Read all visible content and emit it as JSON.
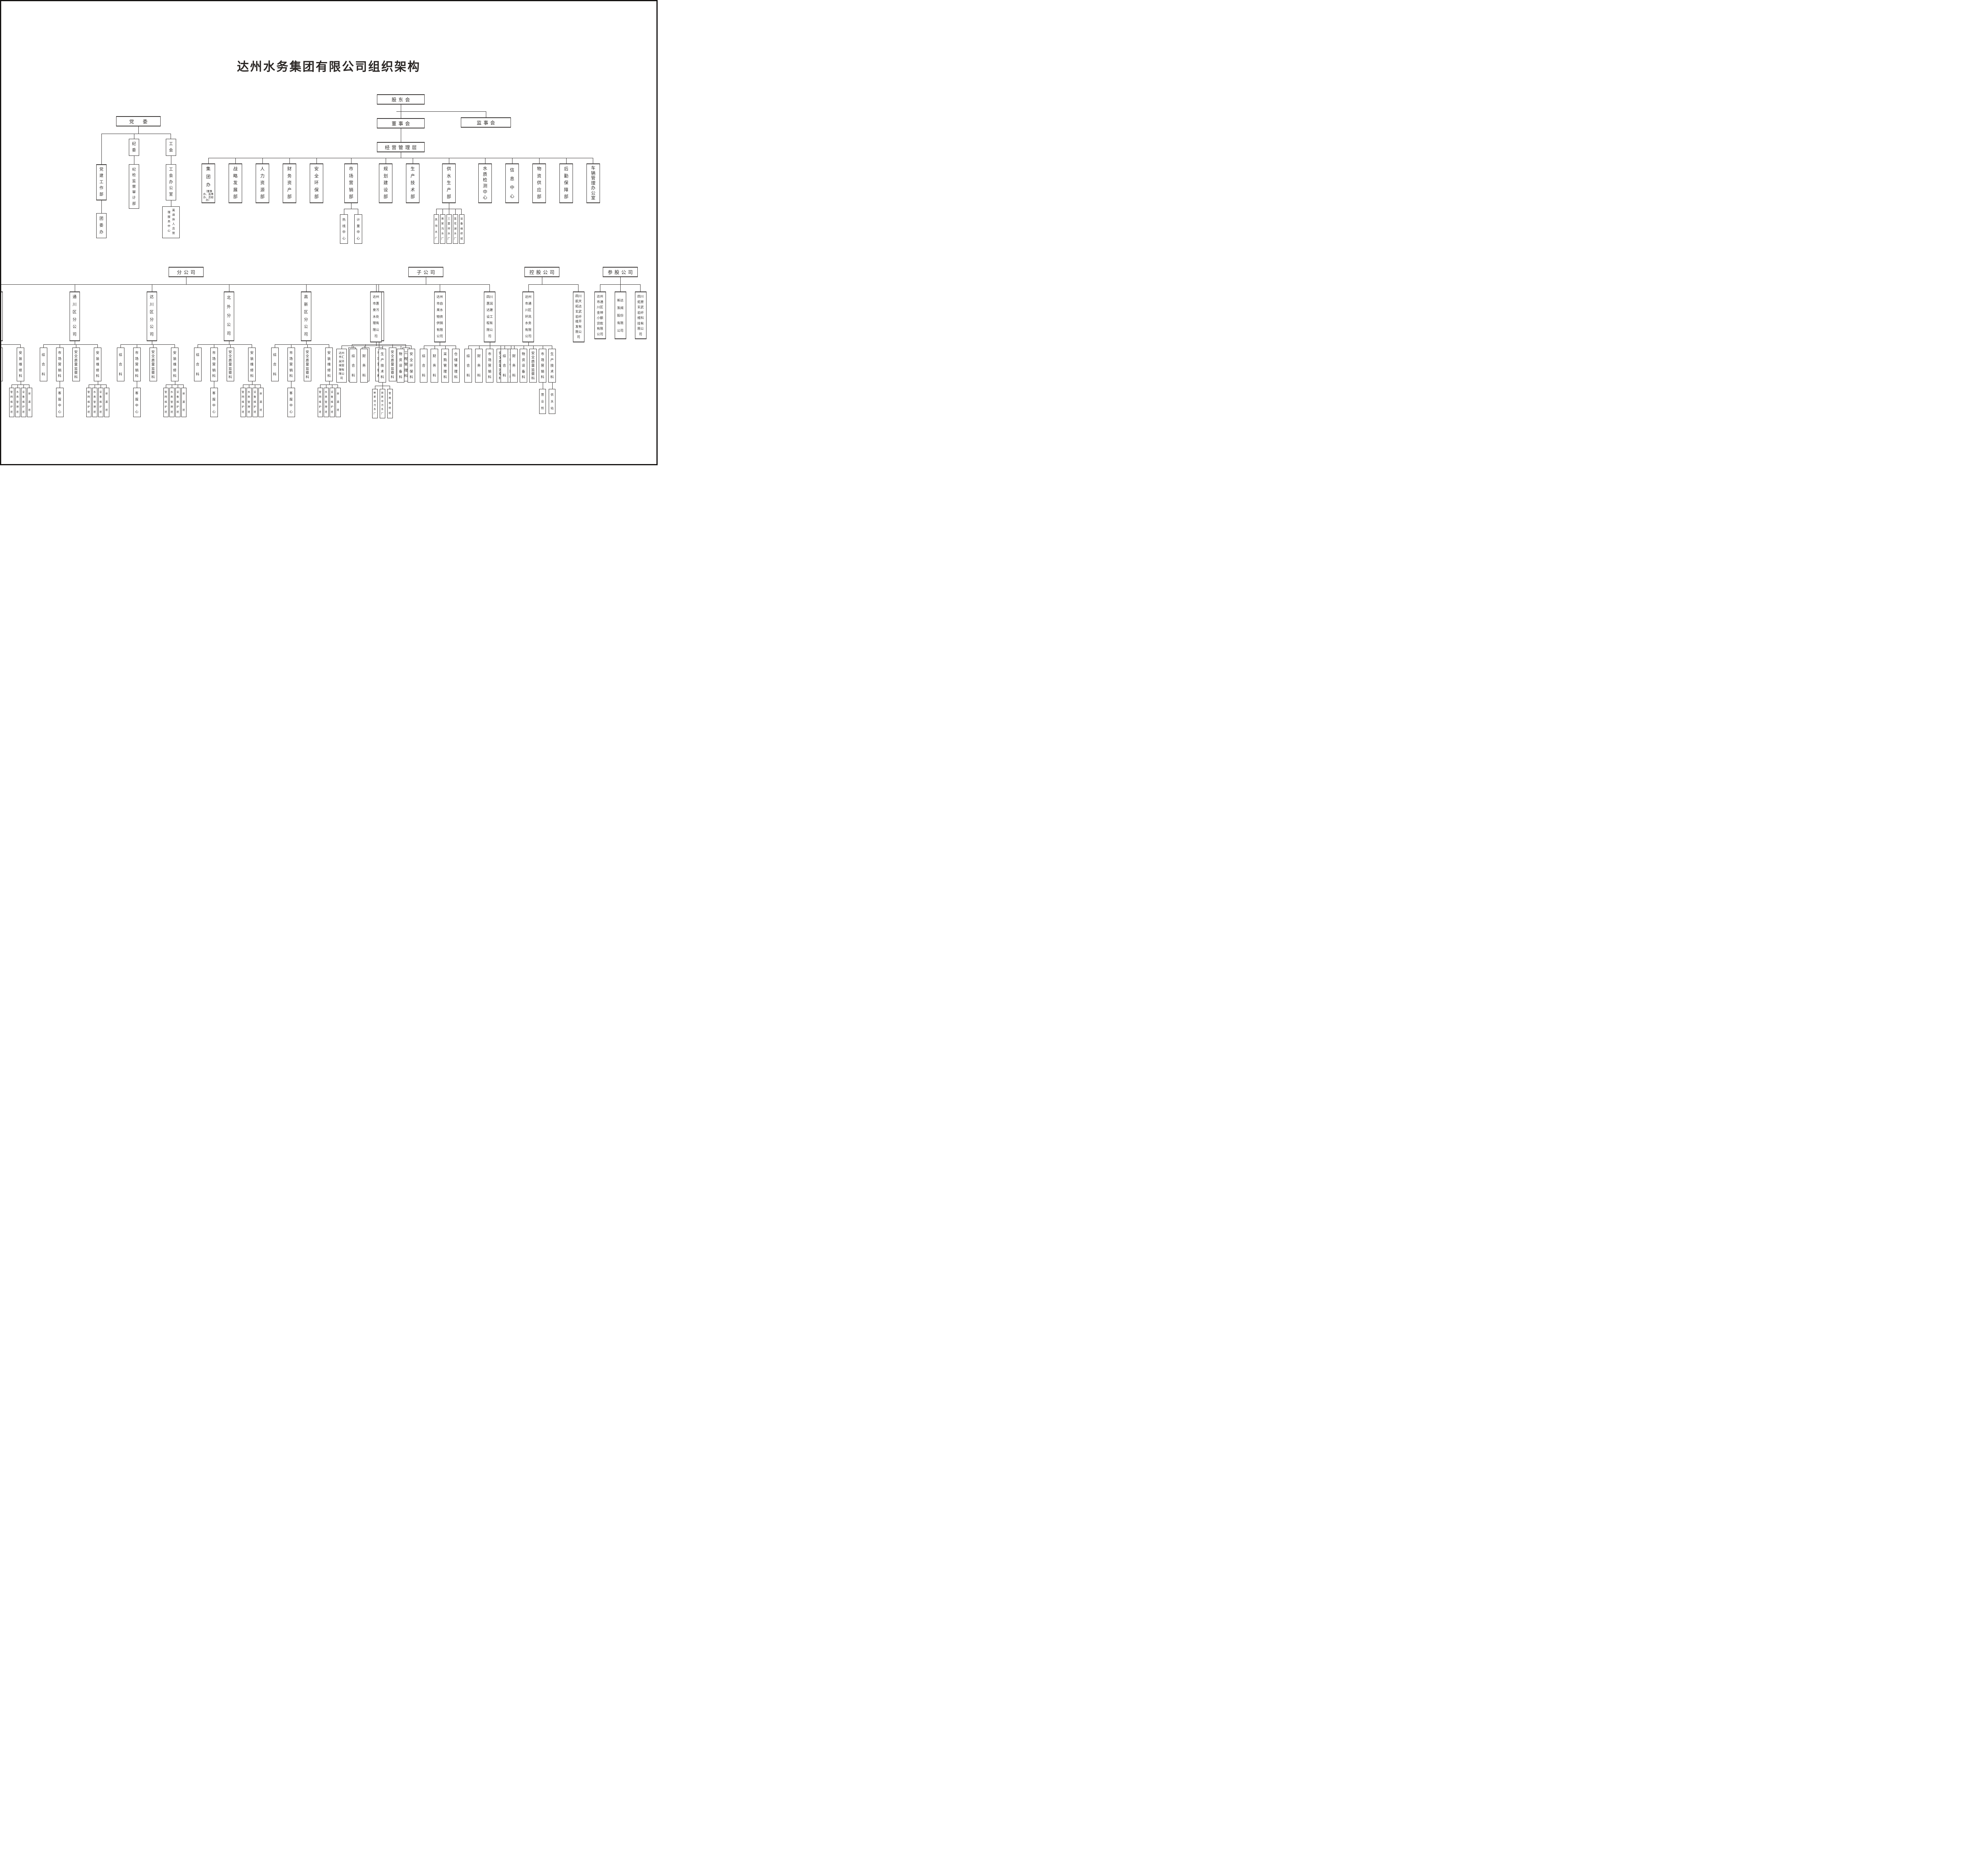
{
  "title": "达州水务集团有限公司组织架构",
  "trees": {
    "supervisory": {
      "label": "监事会"
    },
    "governance": {
      "label": "股东会",
      "children": [
        {
          "label": "董事会",
          "children": [
            {
              "label": "经营管理层",
              "children": [
                {
                  "label": "集团办",
                  "sub": "（董事办、监事办、总经办）"
                },
                {
                  "label": "战略发展部"
                },
                {
                  "label": "人力资源部"
                },
                {
                  "label": "财务资产部"
                },
                {
                  "label": "安全环保部"
                },
                {
                  "label": "市场营销部",
                  "children": [
                    {
                      "label": "热线中心"
                    },
                    {
                      "label": "计量中心"
                    }
                  ]
                },
                {
                  "label": "规划建设部"
                },
                {
                  "label": "生产技术部"
                },
                {
                  "label": "供水生产部",
                  "children": [
                    {
                      "label": "凤翎水厂"
                    },
                    {
                      "label": "吴家沟水厂"
                    },
                    {
                      "label": "三里坪水厂"
                    },
                    {
                      "label": "莲花湖水厂"
                    },
                    {
                      "label": "设备维修班"
                    }
                  ]
                },
                {
                  "label": "水质检测中心"
                },
                {
                  "label": "信息中心"
                },
                {
                  "label": "物资供应部"
                },
                {
                  "label": "后勤保障部"
                },
                {
                  "label": "车辆管理办公室"
                }
              ]
            }
          ]
        }
      ]
    },
    "party": {
      "label": "党　委",
      "children": [
        {
          "label": "党建工作部",
          "children": [
            {
              "label": "团委办"
            }
          ]
        },
        {
          "label": "纪委",
          "children": [
            {
              "label": "纪检监察审计部"
            }
          ]
        },
        {
          "label": "工会",
          "children": [
            {
              "label": "工会办公室",
              "children": [
                {
                  "label": "离退休人员管理服务中心"
                }
              ]
            }
          ]
        }
      ]
    },
    "branches": {
      "label": "分公司",
      "children": [
        {
          "label": "市中区分公司",
          "children": [
            {
              "label": "综合科"
            },
            {
              "label": "市场营销科",
              "children": [
                {
                  "label": "客服中心"
                }
              ]
            },
            {
              "label": "安全质量监察科"
            },
            {
              "label": "安装维修科",
              "children": [
                {
                  "label": "管网维护班"
                },
                {
                  "label": "水表管理班"
                },
                {
                  "label": "设备维护班"
                },
                {
                  "label": "探漏班"
                }
              ]
            }
          ]
        },
        {
          "label": "通川区分公司",
          "children": [
            {
              "label": "综合科"
            },
            {
              "label": "市场营销科",
              "children": [
                {
                  "label": "客服中心"
                }
              ]
            },
            {
              "label": "安全质量监察科"
            },
            {
              "label": "安装维修科",
              "children": [
                {
                  "label": "管网维护班"
                },
                {
                  "label": "水表管理班"
                },
                {
                  "label": "设备维护班"
                },
                {
                  "label": "探漏班"
                }
              ]
            }
          ]
        },
        {
          "label": "达川区分公司",
          "children": [
            {
              "label": "综合科"
            },
            {
              "label": "市场营销科",
              "children": [
                {
                  "label": "客服中心"
                }
              ]
            },
            {
              "label": "安全质量监察科"
            },
            {
              "label": "安装维修科",
              "children": [
                {
                  "label": "管网维护班"
                },
                {
                  "label": "水表管理班"
                },
                {
                  "label": "设备维护班"
                },
                {
                  "label": "探漏班"
                }
              ]
            }
          ]
        },
        {
          "label": "北外分公司",
          "children": [
            {
              "label": "综合科"
            },
            {
              "label": "市场营销科",
              "children": [
                {
                  "label": "客服中心"
                }
              ]
            },
            {
              "label": "安全质量监察科"
            },
            {
              "label": "安装维修科",
              "children": [
                {
                  "label": "管网维护班"
                },
                {
                  "label": "水表管理班"
                },
                {
                  "label": "设备维护班"
                },
                {
                  "label": "探漏班"
                }
              ]
            }
          ]
        },
        {
          "label": "高新区分公司",
          "children": [
            {
              "label": "综合科"
            },
            {
              "label": "市场营销科",
              "children": [
                {
                  "label": "客服中心"
                }
              ]
            },
            {
              "label": "安全质量监察科"
            },
            {
              "label": "安装维修科",
              "children": [
                {
                  "label": "管网维护班"
                },
                {
                  "label": "水表管理班"
                },
                {
                  "label": "设备维护班"
                },
                {
                  "label": "探漏班"
                }
              ]
            }
          ]
        },
        {
          "label": "安装工程分公司",
          "children": [
            {
              "label": "综合科"
            },
            {
              "label": "财务科"
            },
            {
              "label": "市场营销科"
            },
            {
              "label": "安全质量监察科"
            },
            {
              "label": "工程管理科"
            }
          ]
        }
      ]
    },
    "subsidiaries": {
      "label": "子公司",
      "children": [
        {
          "label": "达州市惠泉污水处理有限公司",
          "children": [
            {
              "label": "达州市汇泉环境管理有限公司"
            },
            {
              "label": "综合科"
            },
            {
              "label": "财务科"
            },
            {
              "label": "生产技术科",
              "children": [
                {
                  "label": "鲜家坝污水厂"
                },
                {
                  "label": "周家坝污水厂"
                },
                {
                  "label": "管网维修班"
                }
              ]
            },
            {
              "label": "物资设备科"
            },
            {
              "label": "安全环保科"
            }
          ]
        },
        {
          "label": "达州市自来水物资供销有限公司",
          "children": [
            {
              "label": "综合科"
            },
            {
              "label": "财务科"
            },
            {
              "label": "采购管理科"
            },
            {
              "label": "仓储管理科"
            }
          ]
        },
        {
          "label": "四川惠润达建设工程有限公司",
          "children": [
            {
              "label": "综合科"
            },
            {
              "label": "财务科"
            },
            {
              "label": "市场营销科"
            },
            {
              "label": "安全质量监察科"
            },
            {
              "label": "工程管理科"
            }
          ]
        }
      ]
    },
    "holding": {
      "label": "控股公司",
      "children": [
        {
          "label": "达州市通川区环凤水务有限公司",
          "children": [
            {
              "label": "综合科"
            },
            {
              "label": "财务科"
            },
            {
              "label": "物资设备科"
            },
            {
              "label": "安全质量监察科"
            },
            {
              "label": "市场营销科",
              "children": [
                {
                  "label": "营业所"
                }
              ]
            },
            {
              "label": "生产技术科",
              "children": [
                {
                  "label": "供水站"
                }
              ]
            }
          ]
        },
        {
          "label": "四川航天拓达玄武岩纤维开发有限公司"
        }
      ]
    },
    "invested": {
      "label": "参股公司",
      "children": [
        {
          "label": "达州市通川区金坤小额贷款有限公司"
        },
        {
          "label": "新达泵阀股份有限公司"
        },
        {
          "label": "四川炬原玄武岩纤维科技有限公司"
        }
      ]
    }
  }
}
